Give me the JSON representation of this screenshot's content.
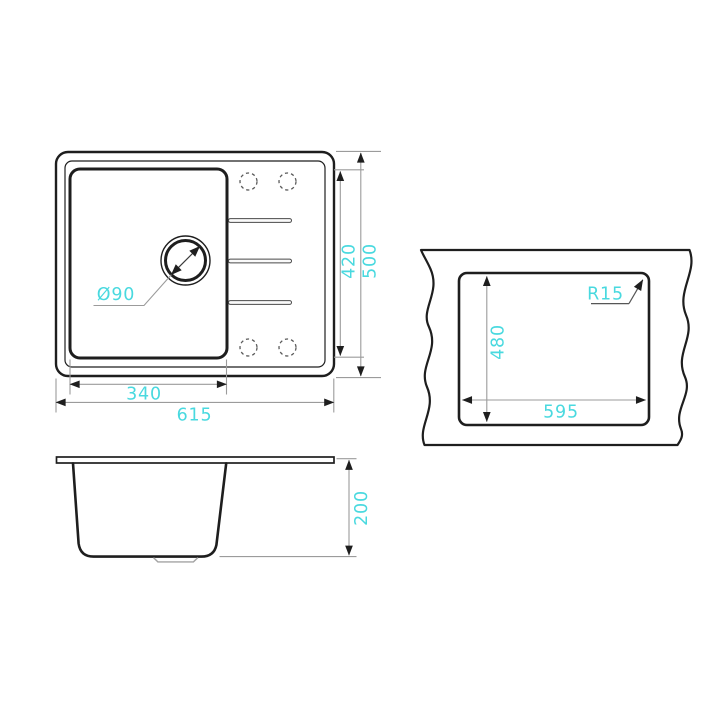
{
  "colors": {
    "accent": "#49d9df",
    "line": "#1e1e1e",
    "dim_line": "#9b9b9b"
  },
  "views": {
    "top_view": {
      "bowl_width": "340",
      "total_width": "615",
      "inner_depth": "420",
      "total_depth": "500",
      "drain_diameter": "Ø90"
    },
    "cutout_view": {
      "cutout_width": "595",
      "cutout_height": "480",
      "corner_radius": "R15"
    },
    "side_view": {
      "bowl_depth": "200"
    }
  }
}
